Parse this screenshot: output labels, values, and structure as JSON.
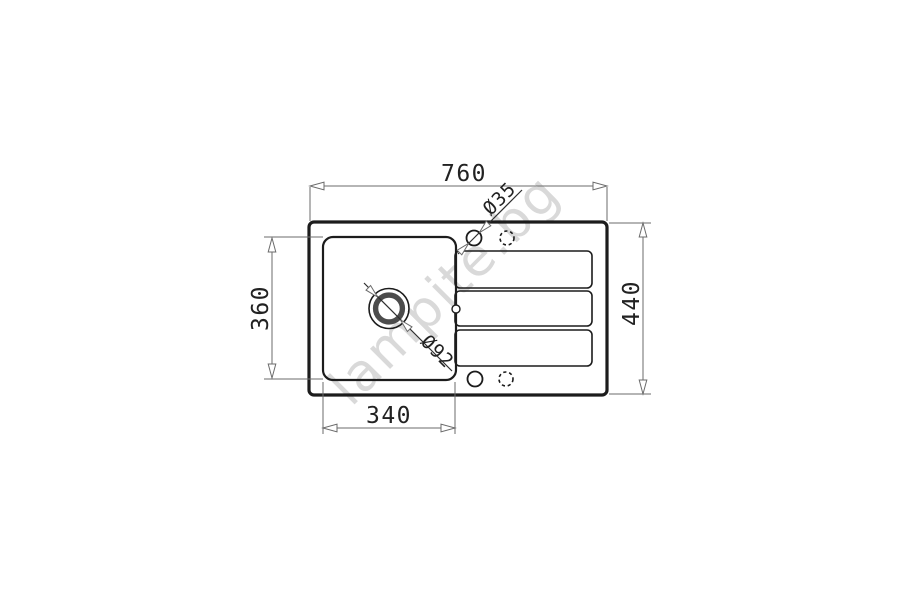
{
  "drawing": {
    "watermark": "lampite.bg",
    "labels": {
      "overall_width": "760",
      "overall_depth": "440",
      "bowl_depth": "360",
      "bowl_width": "340",
      "tap_hole_diameter": "Ø35",
      "drain_diameter": "Ø92"
    },
    "colors": {
      "background": "#ffffff",
      "outline": "#1c1c1c",
      "dimension_line": "#6b6b6b",
      "dimension_text": "#222222",
      "drain_ring": "#4c4c4c",
      "watermark": "#d9d9d9"
    }
  }
}
